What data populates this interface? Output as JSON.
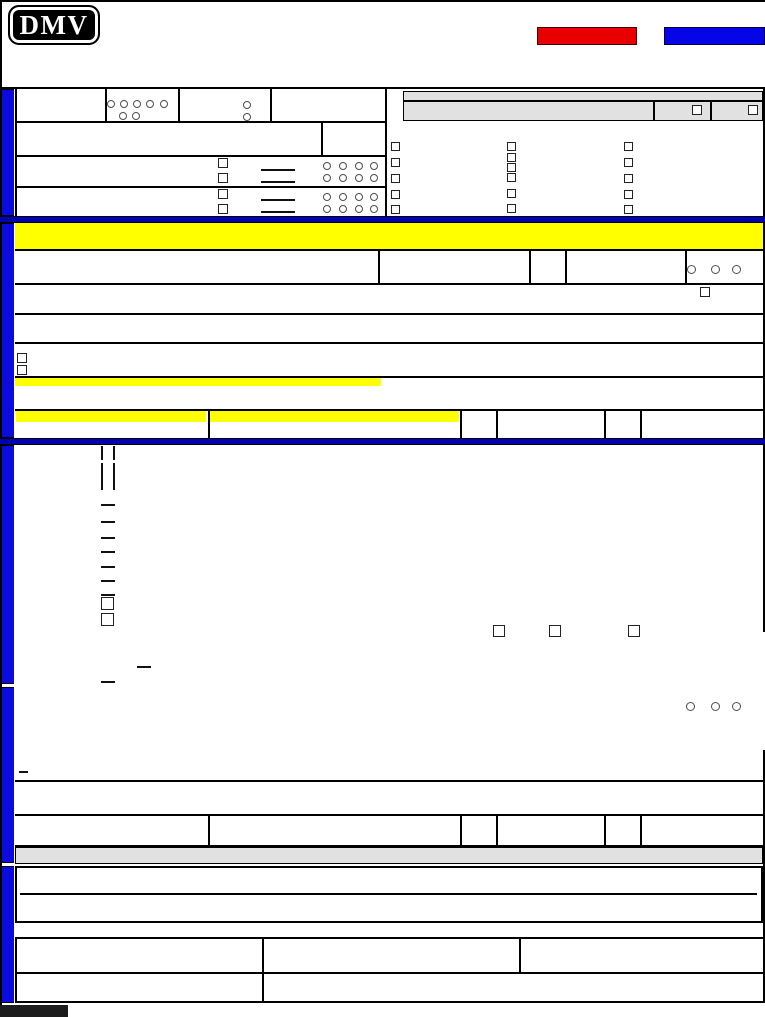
{
  "logo": {
    "text": "DMV"
  },
  "toolbar": {
    "red_button": {
      "label": ""
    },
    "blue_button": {
      "label": ""
    }
  },
  "colors": {
    "accent-red": "#e80000",
    "accent-blue": "#0505e8",
    "bar-blue": "#0b0bdd",
    "divider-blue": "#0000b0",
    "highlight-yellow": "#ffff00",
    "gray-bar": "#e1e1e1",
    "footer-black": "#1c1c1c"
  },
  "form_state": {
    "checkboxes_checked": 0,
    "radios_selected": 0,
    "text_fields_filled": 0
  }
}
